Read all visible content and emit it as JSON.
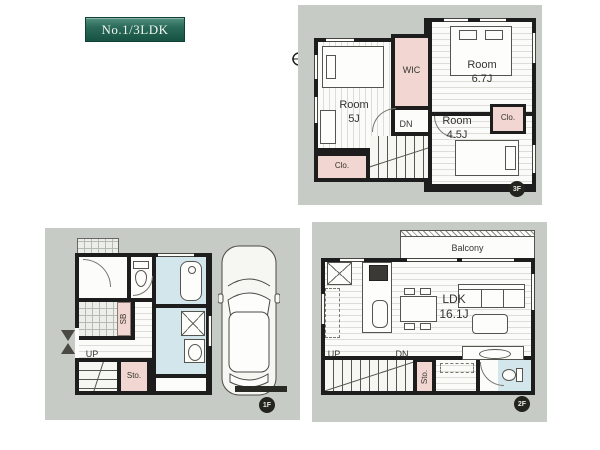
{
  "badge": {
    "label": "No.1/3LDK"
  },
  "compass": {
    "label": "N"
  },
  "colors": {
    "panel_background": "#c7cbc5",
    "wall": "#1d1d1d",
    "closet_pink": "#f2d6d1",
    "wet_area_blue": "#d3e6ec",
    "badge_green": "#2a6a58",
    "floor_tag": "#24241f"
  },
  "floor3": {
    "tag": "3F",
    "room_left": "Room\n5J",
    "room_right": "Room\n6.7J",
    "room_bottom": "Room\n4.5J",
    "wic": "WIC",
    "closet_left": "Clo.",
    "closet_right": "Clo.",
    "down": "DN"
  },
  "floor2": {
    "tag": "2F",
    "balcony": "Balcony",
    "ldk": "LDK\n16.1J",
    "up": "UP",
    "down": "DN",
    "storage": "Sto."
  },
  "floor1": {
    "tag": "1F",
    "up": "UP",
    "storage": "Sto.",
    "shoebox": "SB"
  }
}
